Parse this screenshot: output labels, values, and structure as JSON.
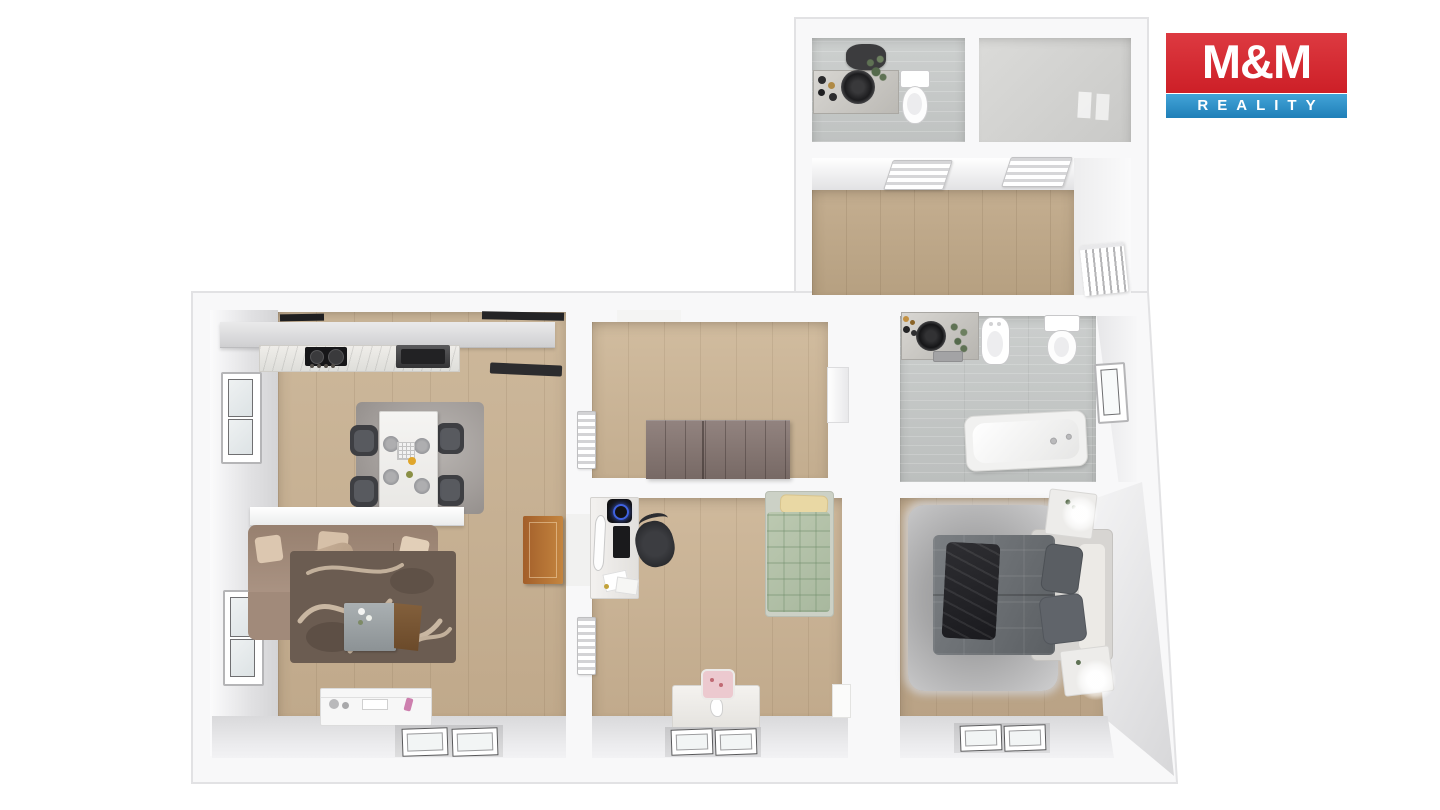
{
  "logo": {
    "mm": "M&M",
    "reality": "REALITY",
    "red": "#cd2027",
    "blue": "#2a8fc7"
  },
  "scene": {
    "type": "3d-floorplan-top-down-render",
    "rooms": [
      {
        "name": "wc-room",
        "furniture": [
          "vanity-counter",
          "round-basin",
          "mirror",
          "plant",
          "toilet"
        ]
      },
      {
        "name": "storage-room",
        "furniture": []
      },
      {
        "name": "hallway",
        "furniture": [
          "radiator",
          "radiator",
          "stair-railing"
        ]
      },
      {
        "name": "living-room-with-kitchen",
        "furniture": [
          "upper-cabinets",
          "marble-counter",
          "cooktop",
          "kitchen-sink",
          "dining-table",
          "dining-chair",
          "dining-chair",
          "dining-chair",
          "dining-chair",
          "dining-rug",
          "partition-counter",
          "corner-sofa",
          "cushions",
          "blanket",
          "patterned-rug",
          "coffee-table",
          "tv-sideboard",
          "window",
          "window",
          "bottom-windows",
          "open-door"
        ]
      },
      {
        "name": "walk-in-closet",
        "furniture": [
          "wardrobe",
          "radiator",
          "wall-niche"
        ]
      },
      {
        "name": "study-bedroom",
        "furniture": [
          "desk",
          "computer-tower",
          "monitor",
          "keyboard",
          "office-chair",
          "single-bed",
          "plaid-duvet",
          "pillow",
          "dresser",
          "stool",
          "radiator",
          "bottom-windows"
        ]
      },
      {
        "name": "bathroom",
        "furniture": [
          "vanity-counter",
          "round-basin",
          "plant",
          "towel",
          "bidet",
          "toilet",
          "bathtub",
          "window"
        ]
      },
      {
        "name": "master-bedroom",
        "furniture": [
          "double-bed",
          "dark-throw",
          "pillows",
          "nightstand-with-lamp",
          "nightstand-with-lamp",
          "shaggy-rug",
          "bottom-windows"
        ]
      }
    ]
  },
  "palette": {
    "wall": "#f8f8f9",
    "wall_stroke": "#e2e2e4",
    "wood_floor": "#c6b093",
    "tile_floor": "#c8cbca",
    "wardrobe": "#85766f",
    "sofa": "#a48d7c",
    "bed_duvet": "#6f7377"
  }
}
